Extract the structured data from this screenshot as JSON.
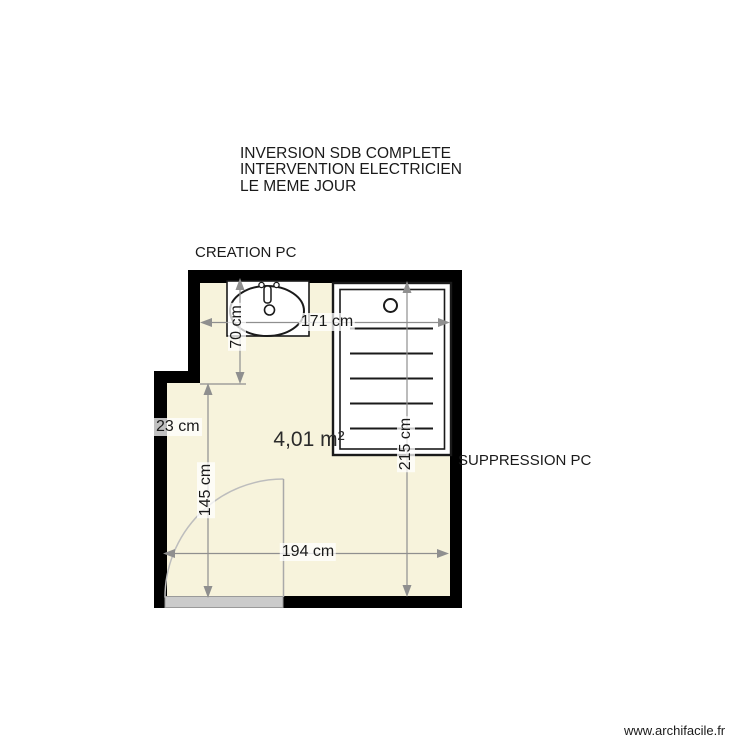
{
  "notes": {
    "line1": "INVERSION SDB COMPLETE",
    "line2": "INTERVENTION ELECTRICIEN",
    "line3": "LE MEME JOUR"
  },
  "labels": {
    "creation_pc": "CREATION PC",
    "suppression_pc": "SUPPRESSION PC",
    "area": "4,01 m²",
    "watermark": "www.archifacile.fr"
  },
  "dimensions": {
    "top_width": "171 cm",
    "sink_depth": "70 cm",
    "wall_step": "23 cm",
    "left_height": "145 cm",
    "shower_height": "215 cm",
    "bottom_width": "194 cm"
  },
  "icons": {
    "sink": "sink-fixture",
    "shower": "shower-fixture",
    "door": "door-swing"
  },
  "colors": {
    "room_fill": "#F7F3DC",
    "wall": "#000000",
    "dimension": "#8F8F8F",
    "fixture_stroke": "#1A1A1A",
    "door_arc": "#BDBDBD",
    "door_leaf": "#A9A9A9",
    "threshold_fill": "#CBCBCB",
    "text": "#1A1A1A"
  }
}
